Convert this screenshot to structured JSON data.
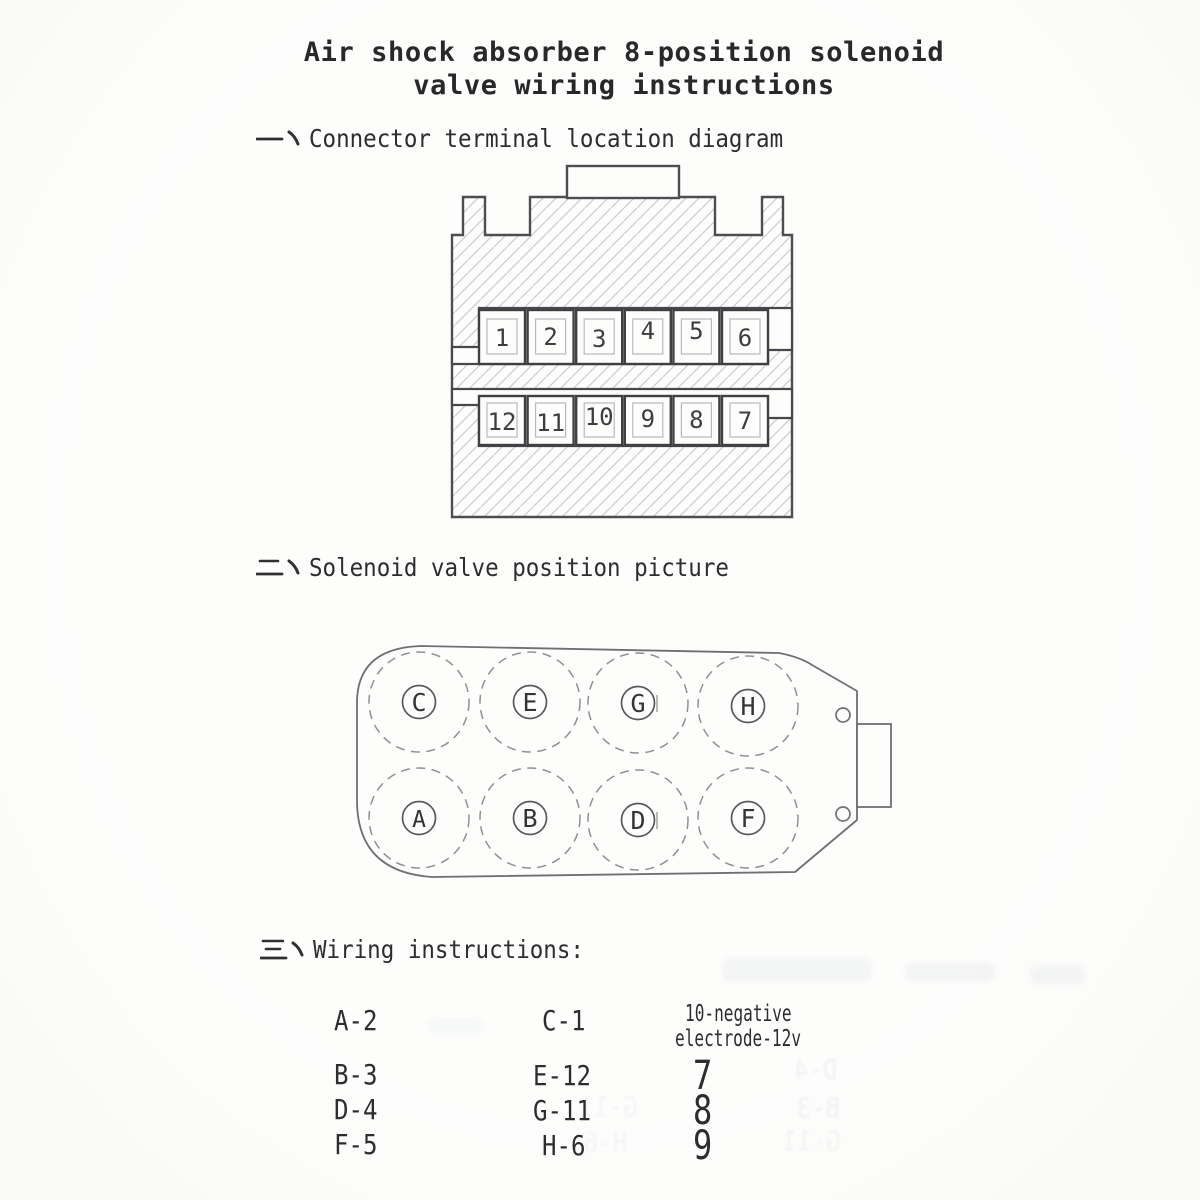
{
  "document": {
    "kind": "scanned instruction sheet",
    "title_line1": "Air shock absorber 8-position solenoid",
    "title_line2": "valve wiring instructions"
  },
  "sections": {
    "one": {
      "marker": "一、",
      "label": "Connector terminal location diagram"
    },
    "two": {
      "marker": "二、",
      "label": "Solenoid valve position picture"
    },
    "three": {
      "marker": "三、",
      "label": "Wiring instructions:"
    }
  },
  "connector": {
    "terminals_top": [
      "1",
      "2",
      "3",
      "4",
      "5",
      "6"
    ],
    "terminals_bottom": [
      "12",
      "11",
      "10",
      "9",
      "8",
      "7"
    ]
  },
  "solenoid": {
    "positions_top": [
      "C",
      "E",
      "G",
      "H"
    ],
    "positions_bottom": [
      "A",
      "B",
      "D",
      "F"
    ]
  },
  "wiring": {
    "column1": [
      "A-2",
      "B-3",
      "D-4",
      "F-5"
    ],
    "column2": [
      "C-1",
      "E-12",
      "G-11",
      "H-6"
    ],
    "column3_note_line1": "10-negative",
    "column3_note_line2": "electrode-12v",
    "column3": [
      "7",
      "8",
      "9"
    ]
  },
  "artifacts": {
    "bleed_through_labels": [
      "D-4",
      "B-3",
      "G-11",
      "G-11",
      "H-6"
    ]
  },
  "colors": {
    "paper": "#fdfdfc",
    "ink": "#2c2e30",
    "drawing_line": "#4c4e51",
    "hatch_line": "#c9cdd3",
    "ghost": "#5d6d7d"
  }
}
